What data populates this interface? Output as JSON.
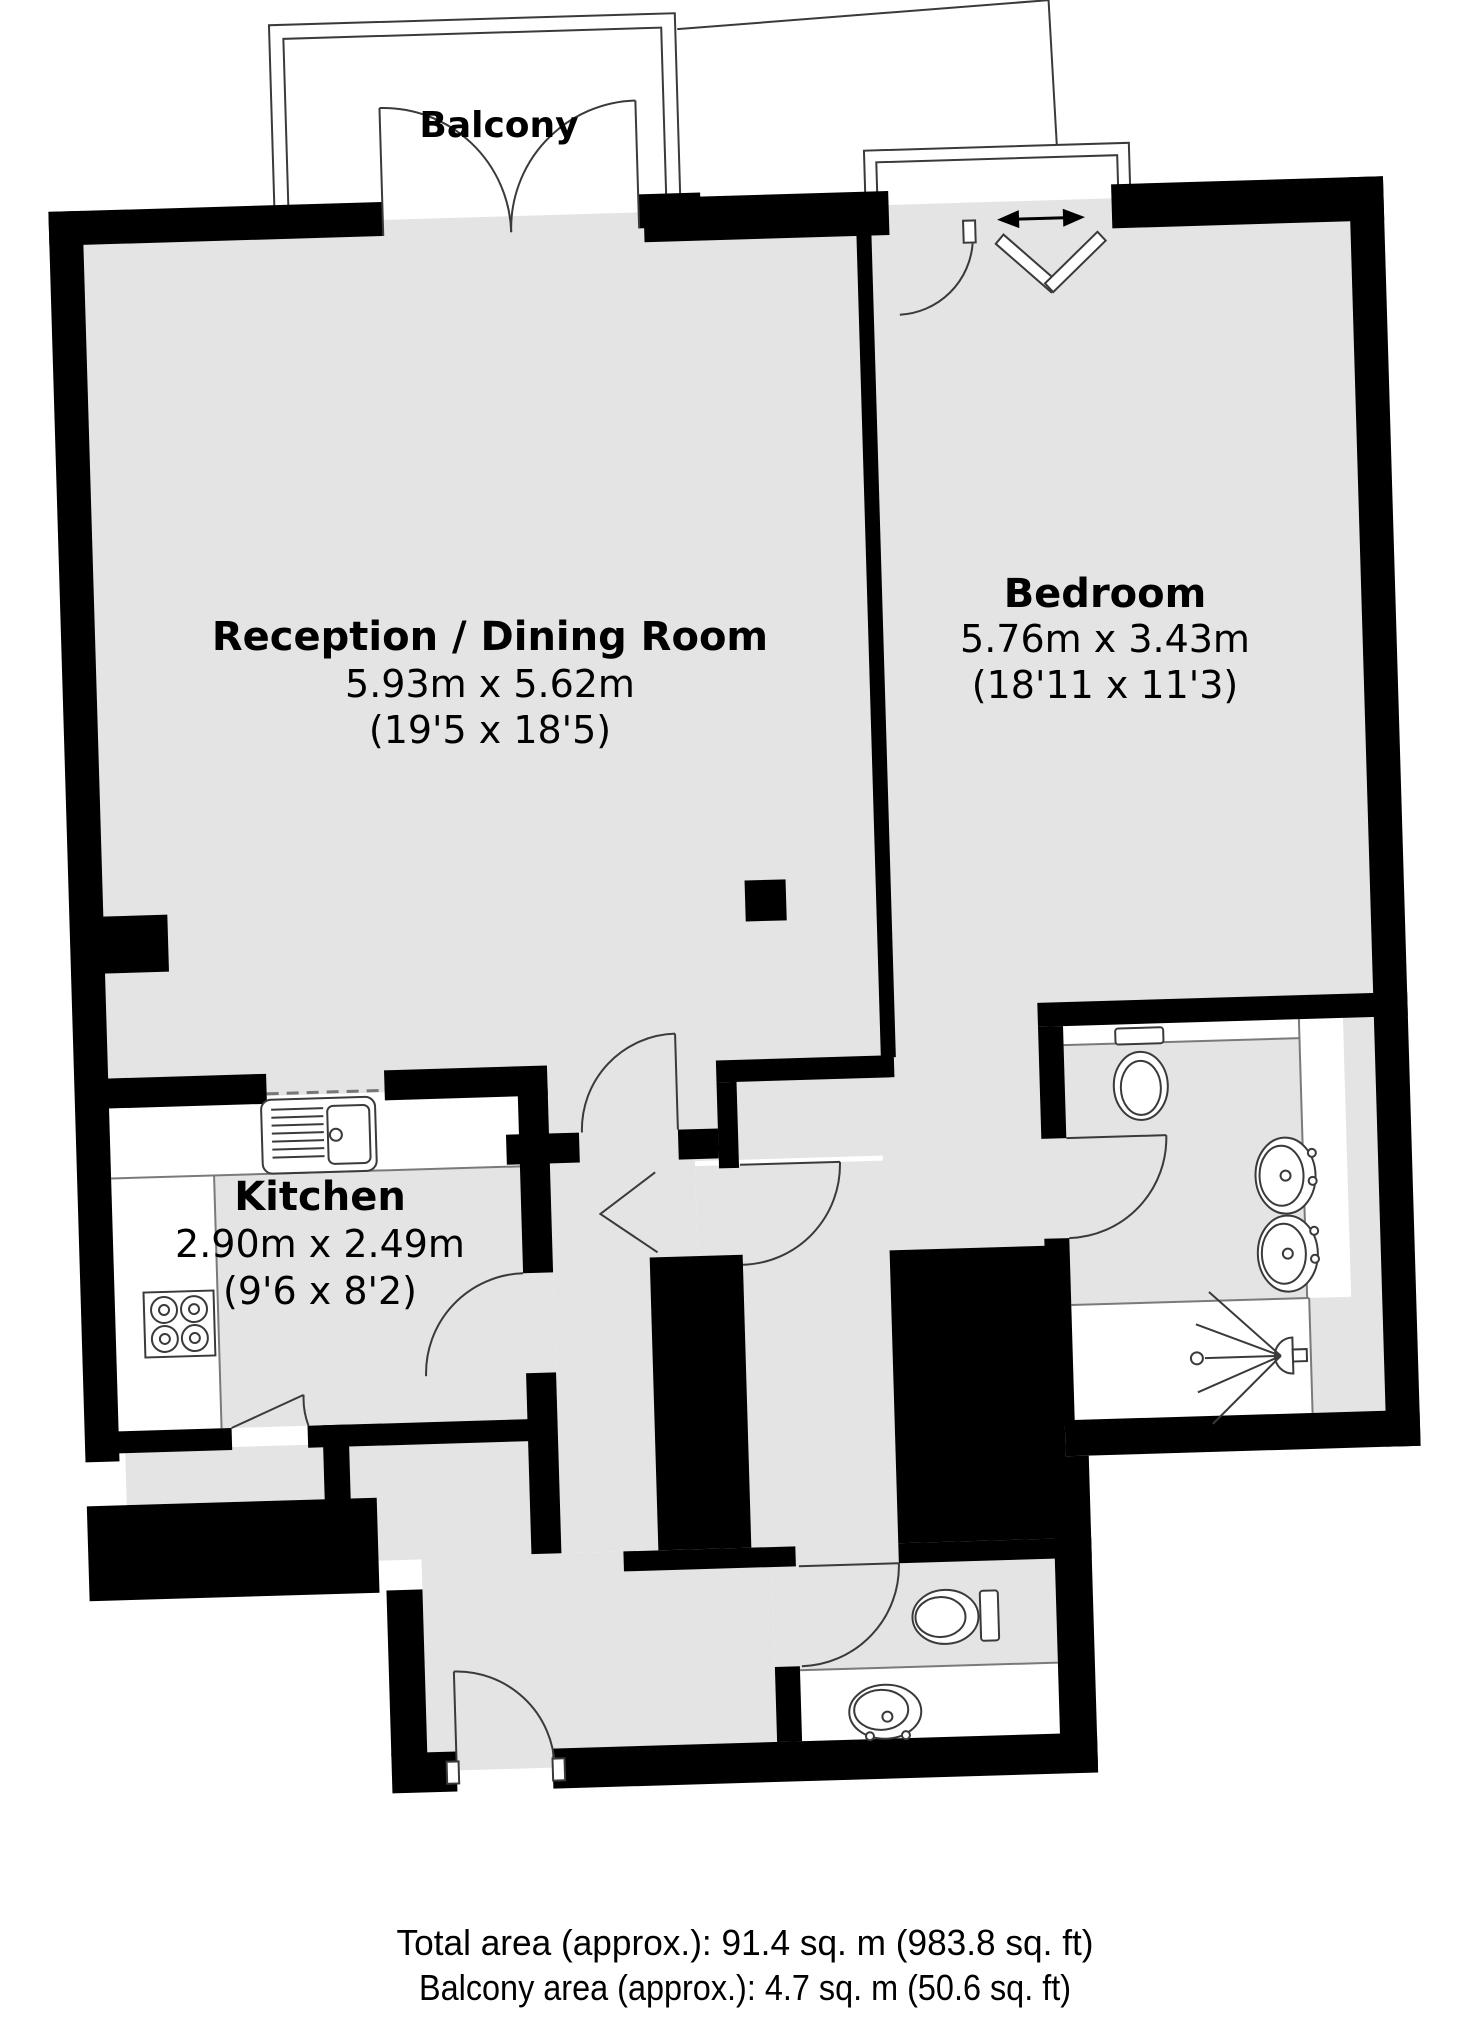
{
  "document_title": "Apartment floor plan",
  "colors": {
    "background": "#ffffff",
    "floor": "#e4e4e4",
    "wall": "#000000",
    "line": "#3a3a3a",
    "dashed_opening": "#777777"
  },
  "labels": {
    "balcony": "Balcony"
  },
  "rooms": {
    "reception": {
      "name": "Reception / Dining Room",
      "metric": "5.93m x 5.62m",
      "imperial": "(19'5 x 18'5)"
    },
    "bedroom": {
      "name": "Bedroom",
      "metric": "5.76m x 3.43m",
      "imperial": "(18'11 x 11'3)"
    },
    "kitchen": {
      "name": "Kitchen",
      "metric": "2.90m x 2.49m",
      "imperial": "(9'6 x 8'2)"
    }
  },
  "fixtures": [
    "kitchen-sink-icon",
    "hob-icon",
    "ensuite-toilet-icon",
    "ensuite-basin-icon",
    "ensuite-basin-icon",
    "shower-icon",
    "wc-toilet-icon",
    "wc-basin-icon",
    "sliding-door-arrow-icon",
    "bifold-door-icon"
  ],
  "footer": {
    "total_area": "Total area (approx.): 91.4 sq. m (983.8 sq. ft)",
    "balcony_area": "Balcony area (approx.): 4.7 sq. m (50.6 sq. ft)"
  }
}
